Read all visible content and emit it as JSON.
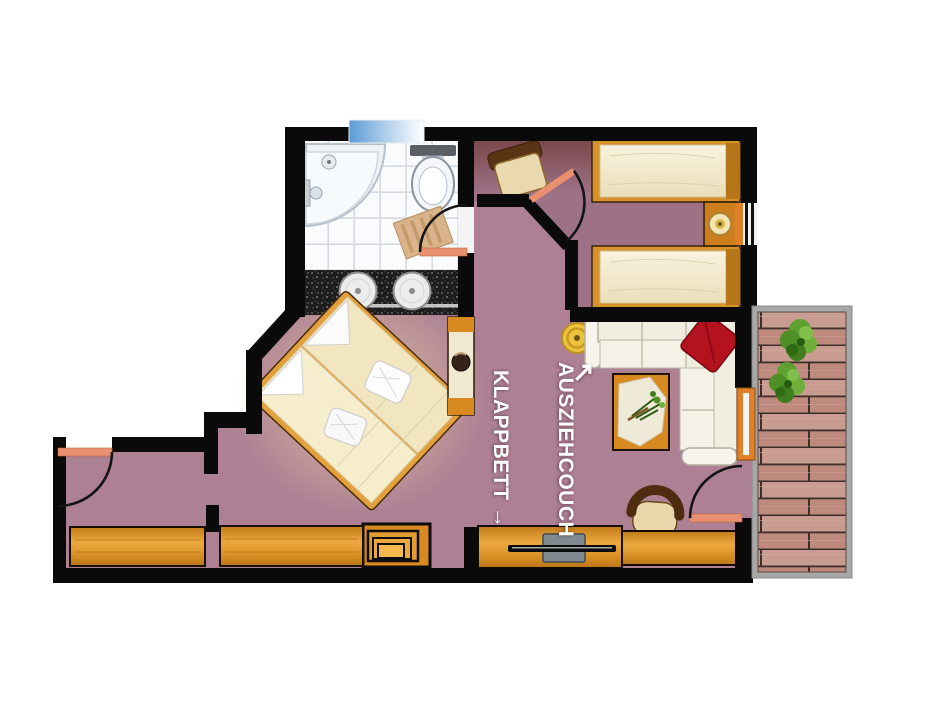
{
  "plan": {
    "type": "apartment floor plan, top view",
    "rooms_visible": [
      "bathroom",
      "twin bedroom",
      "double bedroom",
      "living area",
      "entrance hall",
      "wood deck"
    ]
  },
  "labels": {
    "klappbett": "KLAPPBETT →",
    "ausziehcouch": "AUSZIEHCOUCH",
    "couch_arrow": "↗"
  },
  "colors": {
    "wall": "#0a0a0a",
    "floor": "#ad8094",
    "floorshade": "#5e3a4e",
    "wood": "#dd9426",
    "wooddark": "#c07c1c",
    "mattress": "#f3ecd4",
    "couch": "#f0ede1",
    "pillowred": "#b5121f",
    "doorleaf": "#e89070",
    "deckplank": "#c89c90",
    "deckframe": "#a8a8a8",
    "plantgreen": "#4e8f26",
    "windowblue": "#5b9bd5",
    "tile": "#fafbfd",
    "counter": "#1d1d1d",
    "labeltext": "#ffffff"
  }
}
